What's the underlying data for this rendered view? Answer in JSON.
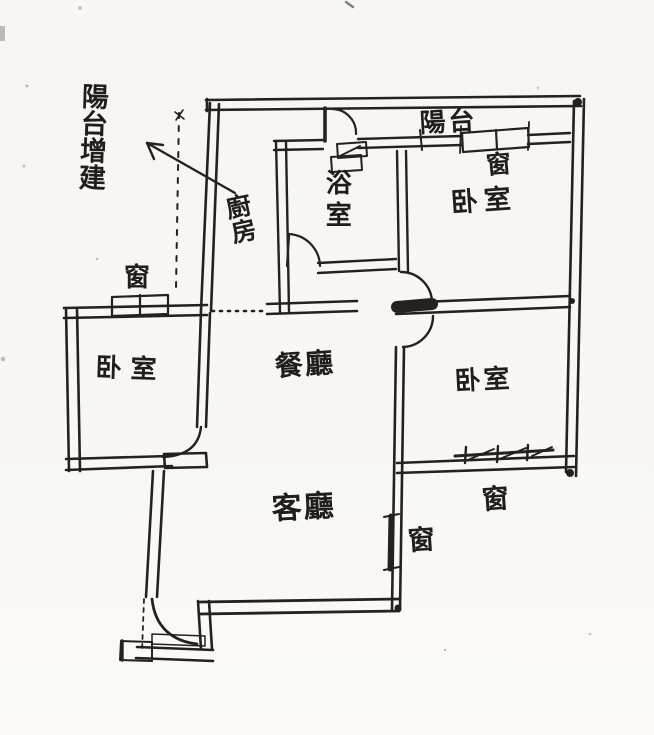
{
  "sketch": {
    "annotation_arrow_note": "陽台增建",
    "rooms": {
      "balcony": "陽台",
      "kitchen": "廚房",
      "bathroom": "浴室",
      "bedroom_top_right": "卧室",
      "bedroom_left": "卧室",
      "bedroom_bottom_right": "卧室",
      "dining_room": "餐廳",
      "living_room": "客廳"
    },
    "windows": {
      "left_bedroom": "窗",
      "top_right_bedroom": "窗",
      "bottom_right_bedroom": "窗",
      "living_room": "窗"
    },
    "colors": {
      "ink": "#25211d",
      "paper": "#f8f7f4"
    }
  }
}
